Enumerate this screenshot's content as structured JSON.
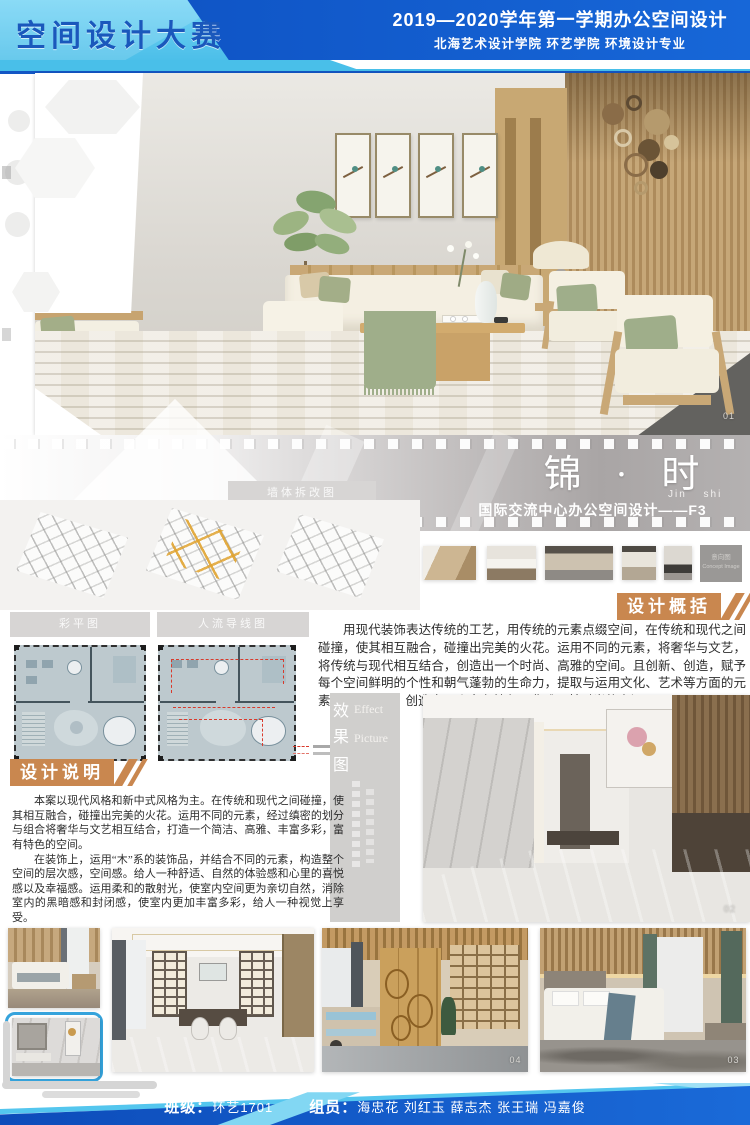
{
  "header": {
    "title": "空间设计大赛",
    "line1": "2019—2020学年第一学期办公空间设计",
    "line2": "北海艺术设计学院  环艺学院  环境设计专业"
  },
  "banner": {
    "cn": "锦 · 时",
    "pinyin": "Jin shi",
    "sub": "国际交流中心办公空间设计——F3"
  },
  "plans": {
    "reno_label": "墙体拆改图",
    "plan_label": "彩平图",
    "flow_label": "人流导线图"
  },
  "summary": {
    "heading": "设计概括",
    "body": "用现代装饰表达传统的工艺，用传统的元素点缀空间，在传统和现代之间碰撞，使其相互融合，碰撞出完美的火花。运用不同的元素，将奢华与文艺，将传统与现代相互结合，创造出一个时尚、高雅的空间。且创新、创造，赋予每个空间鲜明的个性和朝气蓬勃的生命力，提取与运用文化、艺术等方面的元素，结合当下，创造出一个富有特色、典雅及其时尚的空间。"
  },
  "description": {
    "heading": "设计说明",
    "para1": "本案以现代风格和新中式风格为主。在传统和现代之间碰撞，使其相互融合，碰撞出完美的火花。运用不同的元素，经过缜密的划分与组合将奢华与文艺相互结合，打造一个简洁、高雅、丰富多彩，富有特色的空间。",
    "para2": "在装饰上，运用“木”系的装饰品，并结合不同的元素，构造整个空间的层次感，空间感。给人一种舒适、自然的体验感和心里的喜悦感以及幸福感。运用柔和的散射光，使室内空间更为亲切自然，消除室内的黑暗感和封闭感，使室内更加丰富多彩，给人一种视觉上享受。"
  },
  "effect": {
    "cn1": "效",
    "en1": "Effect",
    "cn2": "果",
    "en2": "Picture",
    "cn3": "图"
  },
  "concept": {
    "cn": "意向图",
    "en": "Concept Image"
  },
  "labels": {
    "hero": "01",
    "effect_image": "02",
    "bedroom": "03",
    "office": "04"
  },
  "footer": {
    "class_label": "班级：",
    "class_value": "环艺1701",
    "team_label": "组员：",
    "team_value": "海忠花 刘红玉 薛志杰 张王瑞 冯嘉俊"
  },
  "colors": {
    "accent_blue_dark": "#1356c4",
    "accent_blue_light": "#54c6ee",
    "accent_orange": "#c9874f",
    "flow_red": "#d93a2c",
    "reno_highlight": "#e0a330",
    "plan_fill": "#bdc9ce"
  }
}
